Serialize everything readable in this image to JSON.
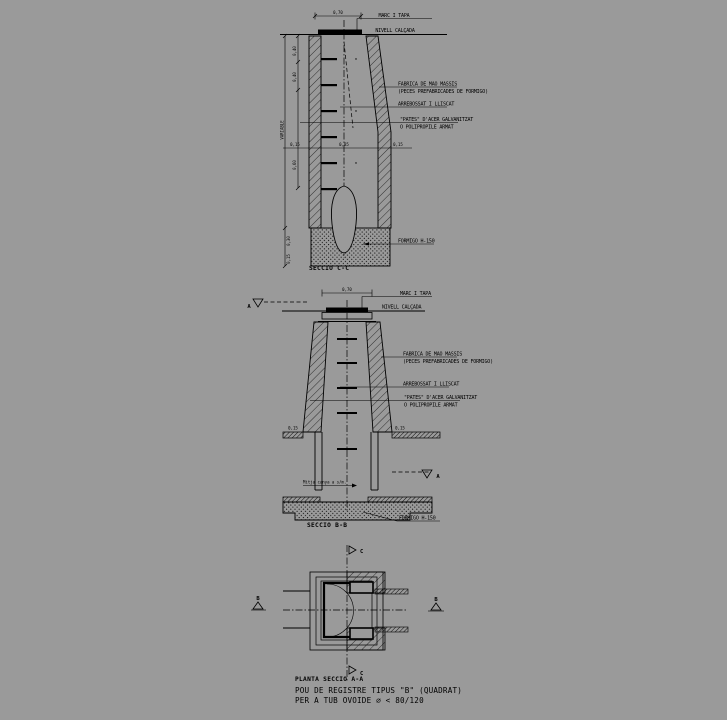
{
  "background": "#9a9a9a",
  "ink": "#000000",
  "labels": {
    "marc_tapa": "MARC I TAPA",
    "nivell_calcada": "NIVELL CALÇADA",
    "fabrica_line1": "FABRICA DE MAO MASSIS",
    "fabrica_line2": "(PECES PREFABRICADES DE FORMIGO)",
    "arrebossat": "ARREBOSSAT I LLISCAT",
    "pates_line1": "\"PATES\" D'ACER GALVANITZAT",
    "pates_line2": "O POLIPROPILE ARMAT",
    "formigo": "FORMIGO H-150",
    "mitja_canya": "Mitja canya a s/m."
  },
  "sections": {
    "cc": {
      "title": "SECCIO C-C",
      "dim_top": "0,70",
      "dims_left": {
        "d1": "0,40",
        "d2": "0,40",
        "d3": "VARIABLE",
        "d4": "0,60",
        "d5": "0,30",
        "d6": "0,15"
      },
      "dims_mid": {
        "left": "0,15",
        "center": "0,85",
        "right": "0,15"
      }
    },
    "bb": {
      "title": "SECCIO B-B",
      "dim_top": "0,70",
      "marker_a": "A",
      "dims": {
        "left": "0,15",
        "right": "0,15"
      }
    },
    "aa": {
      "title": "PLANTA SECCIO A-A",
      "marker_b": "B",
      "marker_c": "C"
    }
  },
  "caption": {
    "line1": "POU DE REGISTRE TIPUS \"B\" (QUADRAT)",
    "line2": "PER A TUB OVOIDE ⌀ < 80/120"
  }
}
